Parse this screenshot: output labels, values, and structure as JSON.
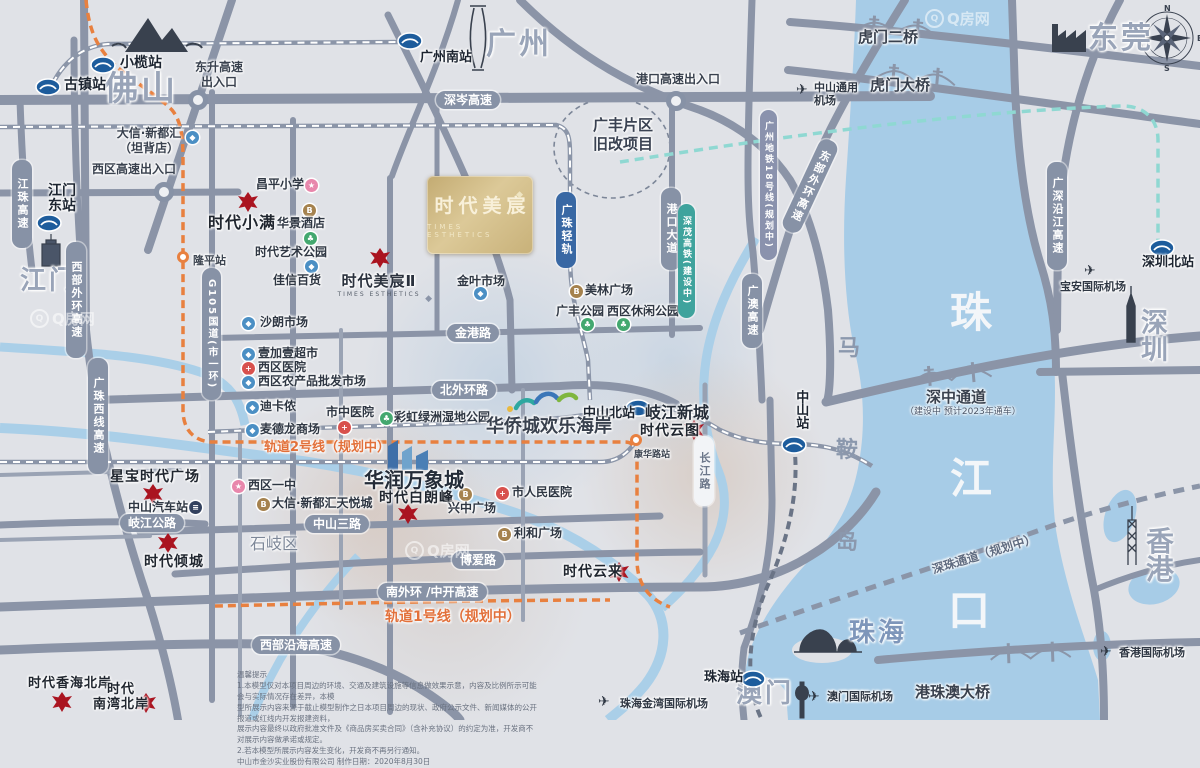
{
  "watermark": "Q房网",
  "main_card": {
    "name": "时代美宸",
    "en": "TIMES ESTHETICS"
  },
  "project2": {
    "name": "时代美宸Ⅱ",
    "en": "TIMES ESTHETICS"
  },
  "compass": {
    "n": "N",
    "e": "E",
    "s": "S",
    "w": "W"
  },
  "cities": [
    {
      "t": "佛山",
      "x": 104,
      "y": 72,
      "fs": 34
    },
    {
      "t": "广州",
      "x": 486,
      "y": 30,
      "fs": 30
    },
    {
      "t": "东莞",
      "x": 1088,
      "y": 24,
      "fs": 30
    },
    {
      "t": "深圳",
      "x": 1141,
      "y": 310,
      "fs": 27
    },
    {
      "t": "江门",
      "x": 20,
      "y": 268,
      "fs": 26
    },
    {
      "t": "珠海",
      "x": 849,
      "y": 620,
      "fs": 26,
      "c": "#7e96ba"
    },
    {
      "t": "澳门",
      "x": 736,
      "y": 681,
      "fs": 26
    },
    {
      "t": "香港",
      "x": 1146,
      "y": 528,
      "fs": 28
    }
  ],
  "water_labels": [
    {
      "t": "珠",
      "x": 950,
      "y": 292,
      "fs": 42,
      "c": "#f3f6f9"
    },
    {
      "t": "江",
      "x": 950,
      "y": 458,
      "fs": 42,
      "c": "#f3f6f9"
    },
    {
      "t": "口",
      "x": 948,
      "y": 590,
      "fs": 42,
      "c": "#f3f6f9"
    },
    {
      "t": "马",
      "x": 838,
      "y": 338,
      "fs": 22,
      "c": "#8b98ad"
    },
    {
      "t": "鞍",
      "x": 836,
      "y": 440,
      "fs": 22,
      "c": "#8b98ad"
    },
    {
      "t": "岛",
      "x": 836,
      "y": 532,
      "fs": 22,
      "c": "#8b98ad"
    }
  ],
  "rail_stations": [
    {
      "t": "小榄站",
      "ix": 90,
      "iy": 56,
      "lx": 120,
      "ly": 56
    },
    {
      "t": "古镇站",
      "ix": 35,
      "iy": 78,
      "lx": 64,
      "ly": 78
    },
    {
      "t": "广州南站",
      "ix": 397,
      "iy": 32,
      "lx": 420,
      "ly": 51,
      "fs": 13
    },
    {
      "t": "江门\n东站",
      "ix": 36,
      "iy": 214,
      "lx": 48,
      "ly": 184
    },
    {
      "t": "深圳北站",
      "ix": 1149,
      "iy": 239,
      "lx": 1142,
      "ly": 256,
      "fs": 13
    },
    {
      "t": "中山北站",
      "ix": 625,
      "iy": 399,
      "lx": 583,
      "ly": 407,
      "fs": 13
    },
    {
      "t": "中山站",
      "ix": 781,
      "iy": 436,
      "lx": 793,
      "ly": 390,
      "fs": 13,
      "vert": 1
    },
    {
      "t": "珠海站",
      "ix": 740,
      "iy": 670,
      "lx": 704,
      "ly": 671,
      "fs": 13
    }
  ],
  "metro_stations": [
    {
      "t": "隆平站",
      "cx": 177,
      "cy": 251,
      "lx": 193,
      "ly": 252,
      "fs": 11
    },
    {
      "t": "康华路站",
      "cx": 630,
      "cy": 434,
      "lx": 634,
      "ly": 447,
      "fs": 9
    }
  ],
  "interchange_nodes": [
    {
      "x": 188,
      "y": 90
    },
    {
      "x": 154,
      "y": 182
    },
    {
      "x": 666,
      "y": 91
    }
  ],
  "airports": [
    {
      "t": "中山通用\n机场",
      "px": 796,
      "py": 83,
      "lx": 814,
      "ly": 82
    },
    {
      "t": "宝安国际机场",
      "px": 1084,
      "py": 264,
      "lx": 1060,
      "ly": 281
    },
    {
      "t": "珠海金湾国际机场",
      "px": 598,
      "py": 695,
      "lx": 620,
      "ly": 698
    },
    {
      "t": "澳门国际机场",
      "px": 808,
      "py": 690,
      "lx": 827,
      "ly": 691
    },
    {
      "t": "香港国际机场",
      "px": 1100,
      "py": 645,
      "lx": 1119,
      "ly": 647
    }
  ],
  "projects": [
    {
      "t": "时代小满",
      "gx": 238,
      "gy": 192,
      "lx": 208,
      "ly": 214,
      "fs": 16
    },
    {
      "t": "星宝时代广场",
      "gx": 143,
      "gy": 484,
      "lx": 110,
      "ly": 469,
      "fs": 14
    },
    {
      "t": "时代倾城",
      "gx": 158,
      "gy": 533,
      "lx": 144,
      "ly": 554,
      "fs": 14
    },
    {
      "t": "时代白朗峰",
      "gx": 398,
      "gy": 504,
      "lx": 379,
      "ly": 490,
      "fs": 14
    },
    {
      "t": "时代云图",
      "gx": 684,
      "gy": 420,
      "lx": 640,
      "ly": 423,
      "fs": 14
    },
    {
      "t": "时代云来",
      "gx": 609,
      "gy": 562,
      "lx": 563,
      "ly": 564,
      "fs": 14
    },
    {
      "t": "时代香海北岸",
      "gx": 52,
      "gy": 692,
      "lx": 28,
      "ly": 677,
      "fs": 13
    },
    {
      "t": "时代\n南湾北岸",
      "gx": 136,
      "gy": 693,
      "lx": 93,
      "ly": 683,
      "fs": 13,
      "ctr": 1
    }
  ],
  "pois": [
    {
      "t": "昌平小学",
      "lx": 256,
      "ly": 178,
      "ix": 305,
      "iy": 179,
      "c": "#e887ac",
      "g": "★"
    },
    {
      "t": "华景酒店",
      "lx": 277,
      "ly": 217,
      "ix": 303,
      "iy": 204,
      "c": "#a5824e",
      "g": "B"
    },
    {
      "t": "时代艺术公园",
      "lx": 255,
      "ly": 246,
      "ix": 304,
      "iy": 232,
      "c": "#43a86f",
      "g": "♣"
    },
    {
      "t": "佳信百货",
      "lx": 273,
      "ly": 274,
      "ix": 305,
      "iy": 260,
      "c": "#4b8fc4",
      "g": "◆"
    },
    {
      "t": "沙朗市场",
      "lx": 260,
      "ly": 316,
      "ix": 242,
      "iy": 317,
      "c": "#4b8fc4",
      "g": "◆"
    },
    {
      "t": "壹加壹超市",
      "lx": 258,
      "ly": 347,
      "ix": 242,
      "iy": 348,
      "c": "#4b8fc4",
      "g": "◆"
    },
    {
      "t": "西区医院",
      "lx": 258,
      "ly": 361,
      "ix": 242,
      "iy": 362,
      "c": "#d8514d",
      "g": "+"
    },
    {
      "t": "西区农产品批发市场",
      "lx": 258,
      "ly": 375,
      "ix": 242,
      "iy": 376,
      "c": "#4b8fc4",
      "g": "◆"
    },
    {
      "t": "迪卡侬",
      "lx": 260,
      "ly": 400,
      "ix": 246,
      "iy": 401,
      "c": "#4b8fc4",
      "g": "◆"
    },
    {
      "t": "麦德龙商场",
      "lx": 260,
      "ly": 423,
      "ix": 246,
      "iy": 424,
      "c": "#4b8fc4",
      "g": "◆"
    },
    {
      "t": "市中医院",
      "lx": 326,
      "ly": 406,
      "ix": 338,
      "iy": 421,
      "c": "#d8514d",
      "g": "+"
    },
    {
      "t": "彩虹绿洲湿地公园",
      "lx": 394,
      "ly": 411,
      "ix": 380,
      "iy": 412,
      "c": "#43a86f",
      "g": "♣"
    },
    {
      "t": "金叶市场",
      "lx": 457,
      "ly": 275,
      "ix": 474,
      "iy": 287,
      "c": "#4b8fc4",
      "g": "◆"
    },
    {
      "t": "美林广场",
      "lx": 585,
      "ly": 284,
      "ix": 570,
      "iy": 285,
      "c": "#a5824e",
      "g": "B"
    },
    {
      "t": "广丰公园",
      "lx": 556,
      "ly": 305,
      "ix": 581,
      "iy": 318,
      "c": "#43a86f",
      "g": "♣"
    },
    {
      "t": "西区休闲公园",
      "lx": 607,
      "ly": 305,
      "ix": 617,
      "iy": 318,
      "c": "#43a86f",
      "g": "♣"
    },
    {
      "t": "西区一中",
      "lx": 248,
      "ly": 479,
      "ix": 232,
      "iy": 480,
      "c": "#e887ac",
      "g": "★"
    },
    {
      "t": "大信·新都汇天悦城",
      "lx": 272,
      "ly": 497,
      "ix": 257,
      "iy": 498,
      "c": "#a5824e",
      "g": "B"
    },
    {
      "t": "市人民医院",
      "lx": 512,
      "ly": 486,
      "ix": 496,
      "iy": 487,
      "c": "#d8514d",
      "g": "+"
    },
    {
      "t": "兴中广场",
      "lx": 448,
      "ly": 502,
      "ix": 459,
      "iy": 488,
      "c": "#a5824e",
      "g": "B"
    },
    {
      "t": "利和广场",
      "lx": 514,
      "ly": 527,
      "ix": 498,
      "iy": 528,
      "c": "#a5824e",
      "g": "B"
    },
    {
      "t": "中山汽车站",
      "lx": 128,
      "ly": 501,
      "ix": 189,
      "iy": 501,
      "c": "#33415e",
      "g": "≡"
    },
    {
      "t": "",
      "lx": 0,
      "ly": 0,
      "ix": 186,
      "iy": 131,
      "c": "#4b8fc4",
      "g": "◆"
    }
  ],
  "road_pills_h": [
    {
      "t": "深岑高速",
      "x": 436,
      "y": 91
    },
    {
      "t": "金港路",
      "x": 447,
      "y": 324
    },
    {
      "t": "北外环路",
      "x": 432,
      "y": 381
    },
    {
      "t": "中山三路",
      "x": 305,
      "y": 515
    },
    {
      "t": "博爱路",
      "x": 452,
      "y": 551
    },
    {
      "t": "南外环 /中开高速",
      "x": 378,
      "y": 583
    },
    {
      "t": "西部沿海高速",
      "x": 252,
      "y": 636
    },
    {
      "t": "岐江公路",
      "x": 120,
      "y": 514
    }
  ],
  "road_pills_v": [
    {
      "t": "江珠高速",
      "x": 12,
      "y": 160,
      "h": 76
    },
    {
      "t": "西部外环高速",
      "x": 66,
      "y": 242,
      "h": 104
    },
    {
      "t": "广珠西线高速",
      "x": 88,
      "y": 358,
      "h": 104
    },
    {
      "t": "G105国道(市一环)",
      "x": 202,
      "y": 268,
      "h": 120,
      "fs": 10
    },
    {
      "t": "港口大道",
      "x": 661,
      "y": 188,
      "h": 70
    },
    {
      "t": "广澳高速",
      "x": 742,
      "y": 274,
      "h": 62
    },
    {
      "t": "长江路",
      "x": 694,
      "y": 436,
      "h": 58,
      "bg": "#f2f4f7",
      "fg": "#6b7689"
    },
    {
      "t": "东部外环高速",
      "x": 800,
      "y": 136,
      "h": 88,
      "rot": 25
    },
    {
      "t": "广深沿江高速",
      "x": 1047,
      "y": 162,
      "h": 96
    },
    {
      "t": "广州地铁18号线(规划中)",
      "x": 760,
      "y": 110,
      "h": 138,
      "bg": "#8a92ad",
      "fs": 9
    },
    {
      "t": "广珠轻轨",
      "x": 556,
      "y": 192,
      "h": 64,
      "bg": "#3968a4"
    },
    {
      "t": "深茂高铁(建设中)",
      "x": 678,
      "y": 204,
      "h": 102,
      "bg": "#3fa39d",
      "fs": 9
    }
  ],
  "line_labels": [
    {
      "t": "虎门二桥",
      "x": 858,
      "y": 26,
      "fs": 15,
      "b": 1,
      "c": "#39414e"
    },
    {
      "t": "虎门大桥",
      "x": 870,
      "y": 74,
      "fs": 15,
      "b": 1,
      "c": "#39414e"
    },
    {
      "t": "深中通道",
      "x": 926,
      "y": 386,
      "fs": 15,
      "b": 1,
      "c": "#39414e"
    },
    {
      "t": "（建设中  预计2023年通车）",
      "x": 905,
      "y": 404,
      "fs": 9,
      "c": "#4a5568"
    },
    {
      "t": "深珠通道（规划中）",
      "x": 930,
      "y": 545,
      "fs": 12,
      "b": 1,
      "c": "#5f6b80",
      "rot": -17
    },
    {
      "t": "港珠澳大桥",
      "x": 915,
      "y": 681,
      "fs": 15,
      "b": 1,
      "c": "#39414e"
    },
    {
      "t": "轨道2号线（规划中）",
      "x": 264,
      "y": 436,
      "fs": 13,
      "b": 1,
      "c": "#e2703a"
    },
    {
      "t": "轨道1号线（规划中）",
      "x": 385,
      "y": 606,
      "fs": 14,
      "b": 1,
      "c": "#e2703a"
    }
  ],
  "area_labels": [
    {
      "t": "广丰片区\n旧改项目",
      "x": 578,
      "y": 116,
      "fs": 15,
      "b": 1,
      "c": "#3a4252",
      "ctr": 1,
      "w": 90
    },
    {
      "t": "岐江新城",
      "x": 645,
      "y": 403,
      "fs": 16,
      "b": 1,
      "c": "#242c38"
    },
    {
      "t": "华润万象城",
      "x": 364,
      "y": 468,
      "fs": 20,
      "b": 1,
      "c": "#242c38"
    },
    {
      "t": "华侨城欢乐海岸",
      "x": 486,
      "y": 416,
      "fs": 18,
      "b": 1,
      "c": "#39414e"
    },
    {
      "t": "石岐区",
      "x": 250,
      "y": 534,
      "fs": 16,
      "b": 0,
      "c": "#7d8798"
    },
    {
      "t": "东升高速\n出入口",
      "x": 188,
      "y": 60,
      "fs": 12,
      "b": 1,
      "c": "#39414e",
      "ctr": 1,
      "w": 62
    },
    {
      "t": "西区高速出入口",
      "x": 92,
      "y": 162,
      "fs": 12,
      "b": 1,
      "c": "#39414e"
    },
    {
      "t": "港口高速出入口",
      "x": 636,
      "y": 72,
      "fs": 12,
      "b": 1,
      "c": "#39414e"
    },
    {
      "t": "大信·新都汇\n（坦背店）",
      "x": 112,
      "y": 126,
      "fs": 12,
      "b": 1,
      "c": "#39414e",
      "ctr": 1,
      "w": 74
    }
  ],
  "watermarks": [
    {
      "x": 925,
      "y": 8
    },
    {
      "x": 30,
      "y": 308
    },
    {
      "x": 405,
      "y": 540
    }
  ],
  "disclaimer": {
    "text": "温馨提示\n1.本模型仅对本项目周边的环境、交通及建筑设施等信息做效果示意，内容及比例所示可能会与实际情况存在差异，本模\n型所展示内容来源于截止模型制作之日本项目周边的现状、政府公示文件、新闻媒体的公开报道或红线内开发报建资料，\n展示内容最终以政府批准文件及《商品房买卖合同》（含补充协议）的约定为准，开发商不对展示内容做承诺或规定。\n2.若本模型所展示内容发生变化，开发商不再另行通知。\n中山市金沙实业股份有限公司                制作日期：2020年8月30日"
  }
}
